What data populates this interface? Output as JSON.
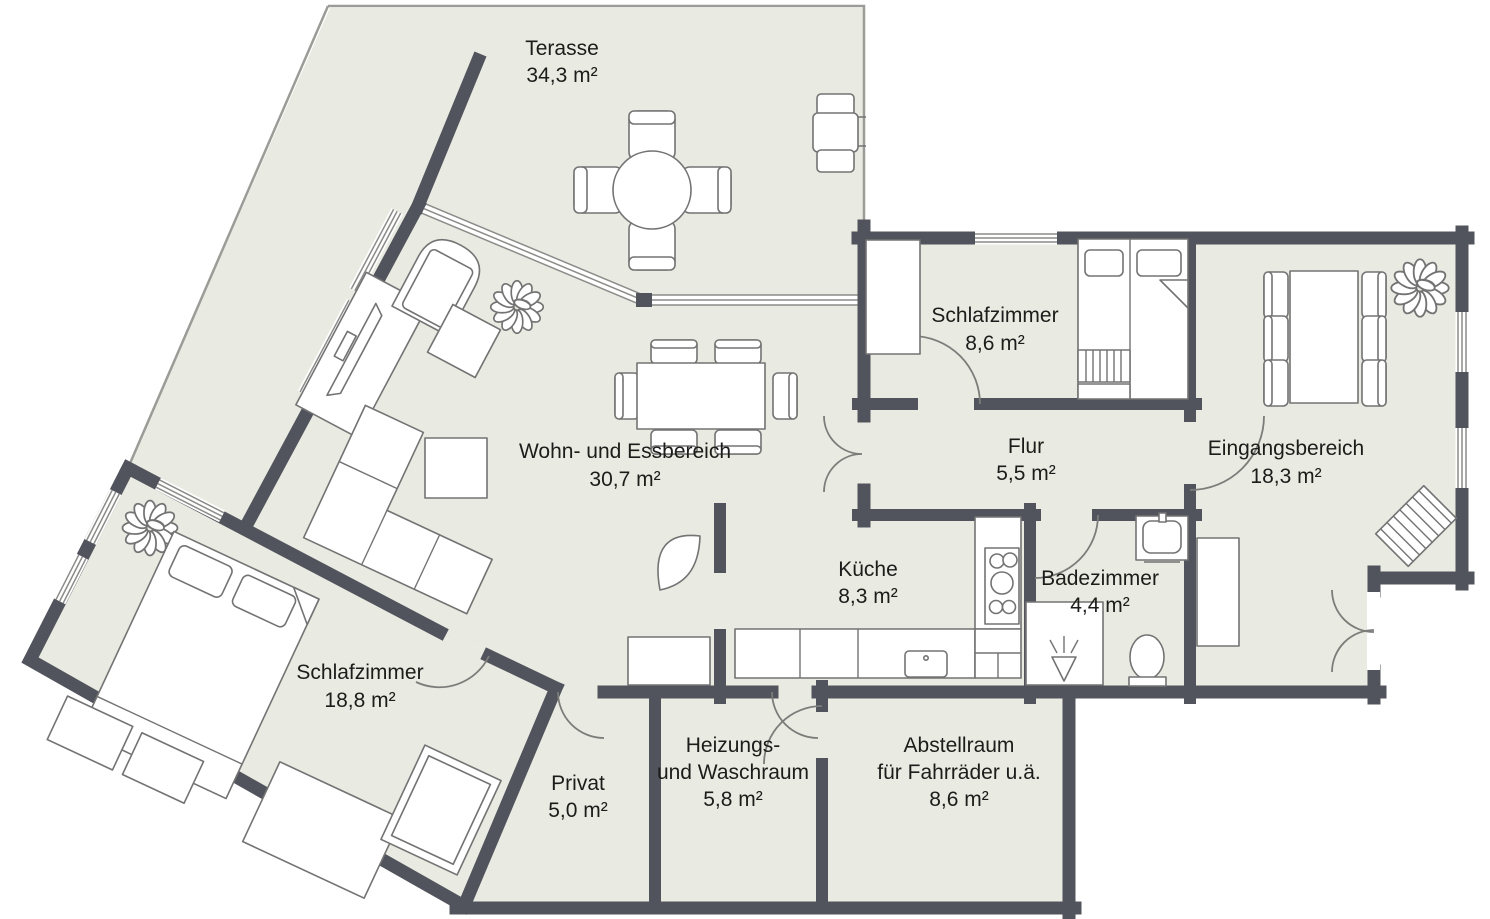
{
  "colors": {
    "floor": "#e9eae1",
    "wall": "#51545c",
    "furniture": "#737373",
    "edge": "#9b9b97",
    "text": "#1c1c1a",
    "background": "#ffffff"
  },
  "rooms": {
    "terrasse": {
      "name": "Terasse",
      "area": "34,3 m²"
    },
    "schlafzimmer_klein": {
      "name": "Schlafzimmer",
      "area": "8,6 m²"
    },
    "wohn_essbereich": {
      "name": "Wohn- und Essbereich",
      "area": "30,7 m²"
    },
    "flur": {
      "name": "Flur",
      "area": "5,5 m²"
    },
    "eingangsbereich": {
      "name": "Eingangsbereich",
      "area": "18,3 m²"
    },
    "kueche": {
      "name": "Küche",
      "area": "8,3 m²"
    },
    "badezimmer": {
      "name": "Badezimmer",
      "area": "4,4 m²"
    },
    "schlafzimmer_gross": {
      "name": "Schlafzimmer",
      "area": "18,8 m²"
    },
    "privat": {
      "name": "Privat",
      "area": "5,0 m²"
    },
    "heizung_waschraum": {
      "name_line1": "Heizungs-",
      "name_line2": "und Waschraum",
      "area": "5,8 m²"
    },
    "abstellraum": {
      "name_line1": "Abstellraum",
      "name_line2": "für Fahrräder u.ä.",
      "area": "8,6 m²"
    }
  },
  "icons": {
    "plant-icon": "leaf-rosette",
    "door-icon": "quarter-circle-arc",
    "window-icon": "triple-line-band",
    "shower-icon": "triangle-with-spray",
    "stove-icon": "burner-circles",
    "toilet-icon": "oval-with-tank",
    "doormat-icon": "striped-rect"
  }
}
